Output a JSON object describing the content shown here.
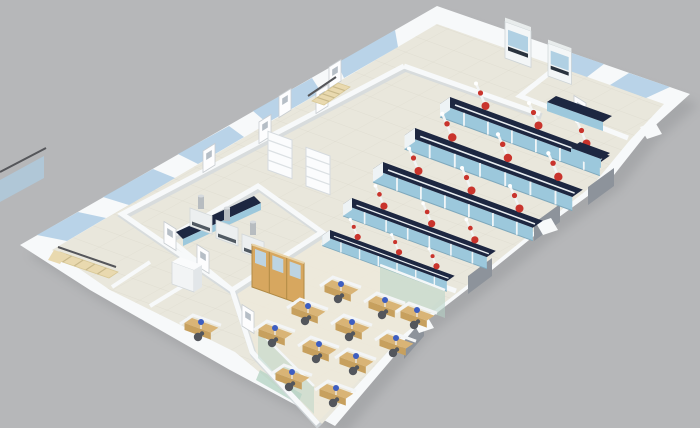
{
  "scene": {
    "type": "3d-isometric-architectural-render",
    "subject": "Cutaway 3D floor plan of a laboratory and office facility",
    "description": "High-angle isometric 3D rendering of a single-storey laboratory floor plan on a plain gray backdrop: an open chemistry lab with five dark-topped island benches and red snorkel fume extractors, two small labs with wall benches along the north-east facade, a prep room with canopy fume hoods and shelving, an open-plan office with wooden cubicle workstations and computer monitors, corridors with white glazed doors, glass facade panels and two pale-wood staircases",
    "background": "plain gray studio backdrop",
    "camera": "elevated isometric view from the south"
  },
  "colors": {
    "background": "#b6b7b9",
    "shadow": "#939497",
    "wall": "#f7f9fa",
    "wall_shade": "#d3d9dd",
    "floor": "#e9e7dc",
    "floor_office": "#ede9da",
    "glass_blue": "#aecde4",
    "glass_green": "#b7d4c6",
    "bench_top": "#1d2741",
    "bench_front": "#9cc8dc",
    "bench_frame": "#eef3f5",
    "extractor_red": "#c9342c",
    "stem_white": "#f3f5f5",
    "desk_wood": "#d9b476",
    "desk_wood_dark": "#c7a05e",
    "cabinet_wood": "#d7a75f",
    "monitor_blue": "#3d5ec1",
    "chair_dark": "#53565c",
    "stair_wood": "#e9d9af",
    "handrail": "#55565a",
    "window_gray": "#8d939b",
    "door_white": "#fdfdfe"
  },
  "rooms": {
    "open_lab": {
      "label": "Open laboratory with five island benches and overhead red fume extractors"
    },
    "small_labs": {
      "label": "Two small laboratory rooms along the north-east wall with wall benches and fume cabinets"
    },
    "fume_room": {
      "label": "Prep room with canopy fume hoods, dark worktop and shelving units"
    },
    "office": {
      "label": "Open-plan office with eleven wooden cubicle workstations, monitors and glass partitions"
    },
    "corridor": {
      "label": "Corridor along the north-west facade with white glazed doors"
    },
    "side_rooms": {
      "label": "Small side rooms with a single desk, chair and copier"
    },
    "stair_upper": {
      "label": "Pale wood staircase near the north corner"
    },
    "stair_west": {
      "label": "Pale wood staircase at the west corner with dark handrails"
    },
    "empty_room": {
      "label": "Unfurnished room near the north corner"
    }
  },
  "objects": {
    "island_bench_rows": 5,
    "fume_extractors": 15,
    "office_workstations": 11,
    "side_desks": 1,
    "computer_monitors": 12,
    "office_chairs": 12,
    "canopy_fume_hoods": 3,
    "benchtop_fume_cabinets": 2,
    "wall_benches": 3,
    "wooden_cabinet_banks": 1,
    "shelving_units": 2,
    "copiers": 1,
    "staircases": 2,
    "doors": 9,
    "facade_windows_gray": 4,
    "nw_glass_panels": 5,
    "ne_glass_panels": 2,
    "sw_glass_panels": 1,
    "interior_glass_partitions": 2,
    "entrance_canopies": 1
  }
}
